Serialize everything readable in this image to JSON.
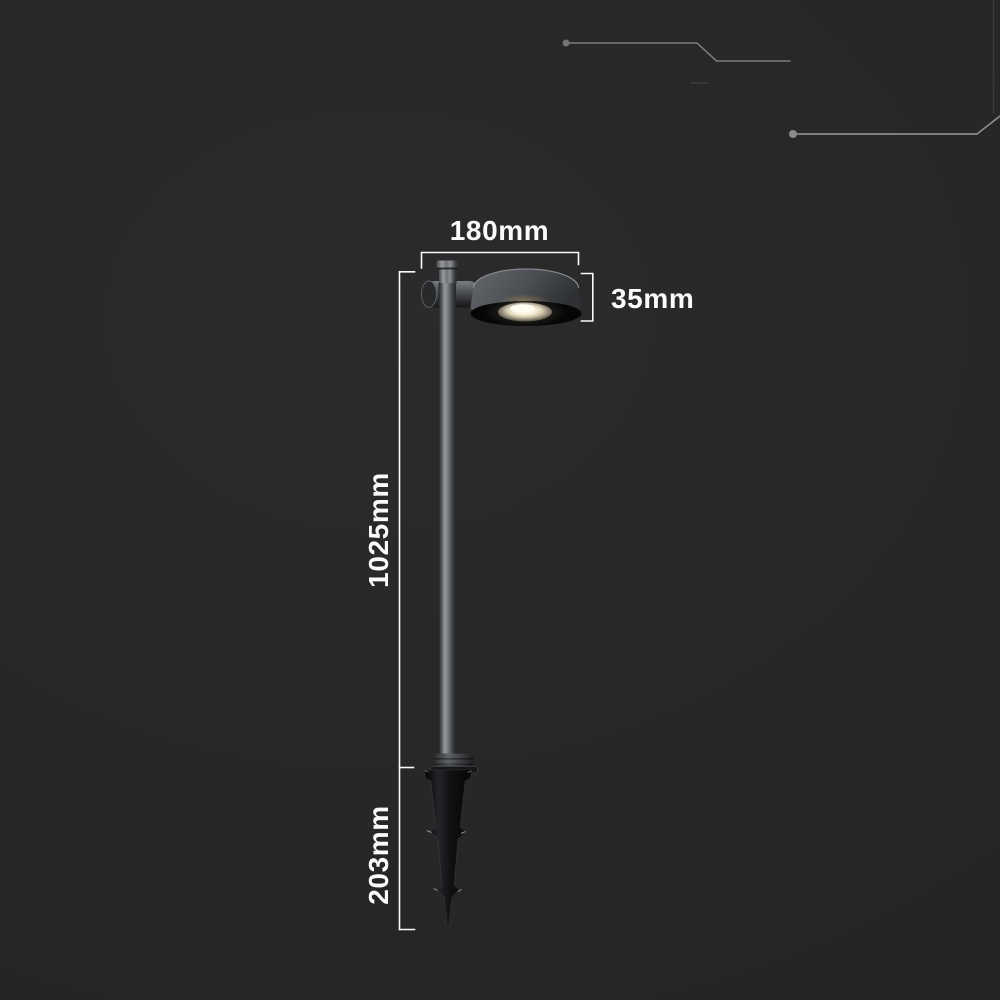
{
  "diagram": {
    "title": "Garden spike luminaire dimension diagram",
    "labels": {
      "head_width": "180mm",
      "head_height": "35mm",
      "pole_height": "1025mm",
      "spike_length": "203mm"
    }
  },
  "colors": {
    "bg": "#272727",
    "label-text": "#fafafa",
    "dim-line": "#fafafa",
    "decor-line": "#828282",
    "decor-line-faint": "#3d3d3d",
    "fixture-gray": "#4b4e51",
    "fixture-black": "#0b0b0c",
    "lens-glow": "#fff6dc"
  }
}
